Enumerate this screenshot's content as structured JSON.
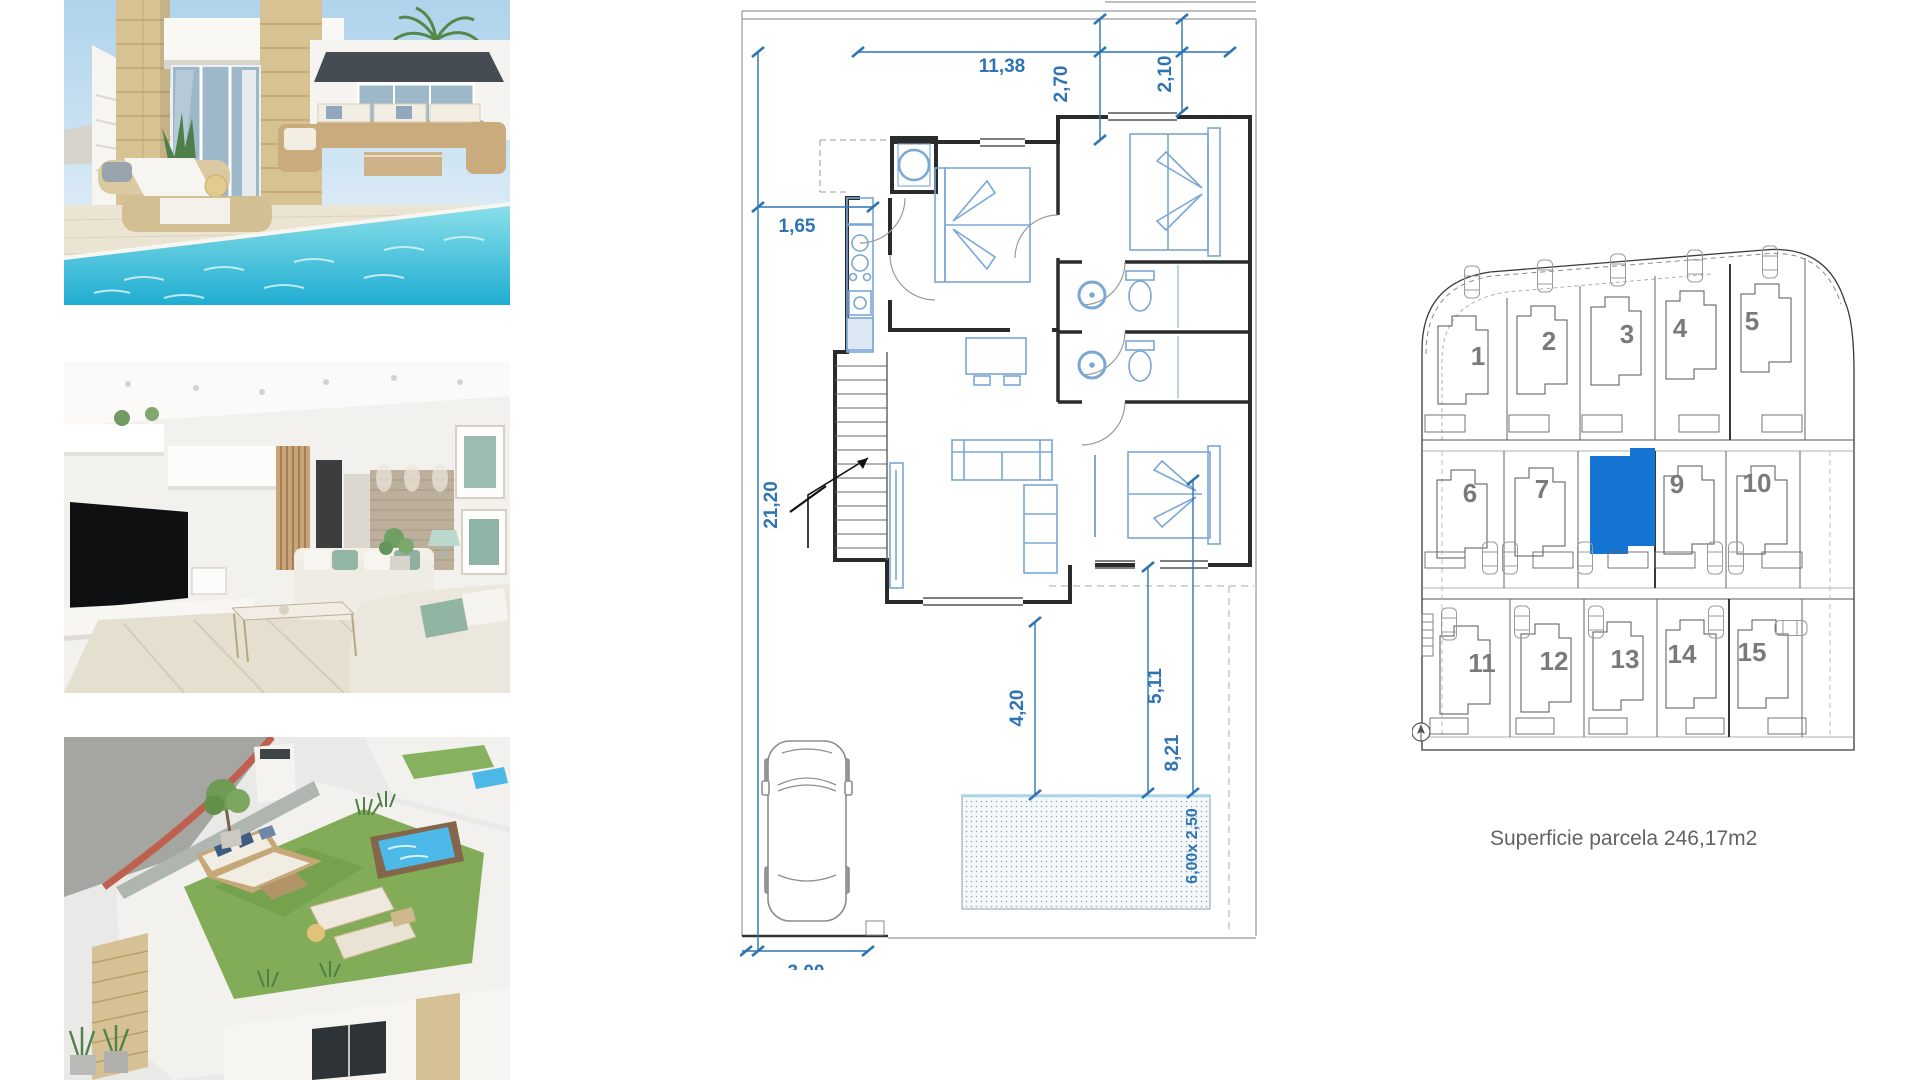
{
  "floor_plan": {
    "dim_color": "#2E74B5",
    "dims": {
      "top_width": "11,38",
      "porch_depth": "2,70",
      "entry_depth": "2,10",
      "left_offset": "1,65",
      "plot_depth": "21,20",
      "drive_width": "3,00",
      "terrace_depth": "4,20",
      "garden_depth": "5,11",
      "pool_offset": "8,21",
      "pool_size": "6,00x 2,50"
    }
  },
  "site_plan": {
    "caption": "Superficie parcela 246,17m2",
    "highlight_color": "#1575D4",
    "highlighted_parcel": "8",
    "parcels": {
      "p1": "1",
      "p2": "2",
      "p3": "3",
      "p4": "4",
      "p5": "5",
      "p6": "6",
      "p7": "7",
      "p9": "9",
      "p10": "10",
      "p11": "11",
      "p12": "12",
      "p13": "13",
      "p14": "14",
      "p15": "15"
    }
  },
  "photos": {
    "exterior": "villa-exterior-pool",
    "interior": "living-room-interior",
    "rooftop": "roof-terrace-aerial"
  },
  "colors": {
    "pool_water": "#2FB6D4",
    "stone": "#D6C193",
    "turf": "#82AC57",
    "dimension_blue": "#2E74B5",
    "wall_black": "#2B2B2B"
  }
}
